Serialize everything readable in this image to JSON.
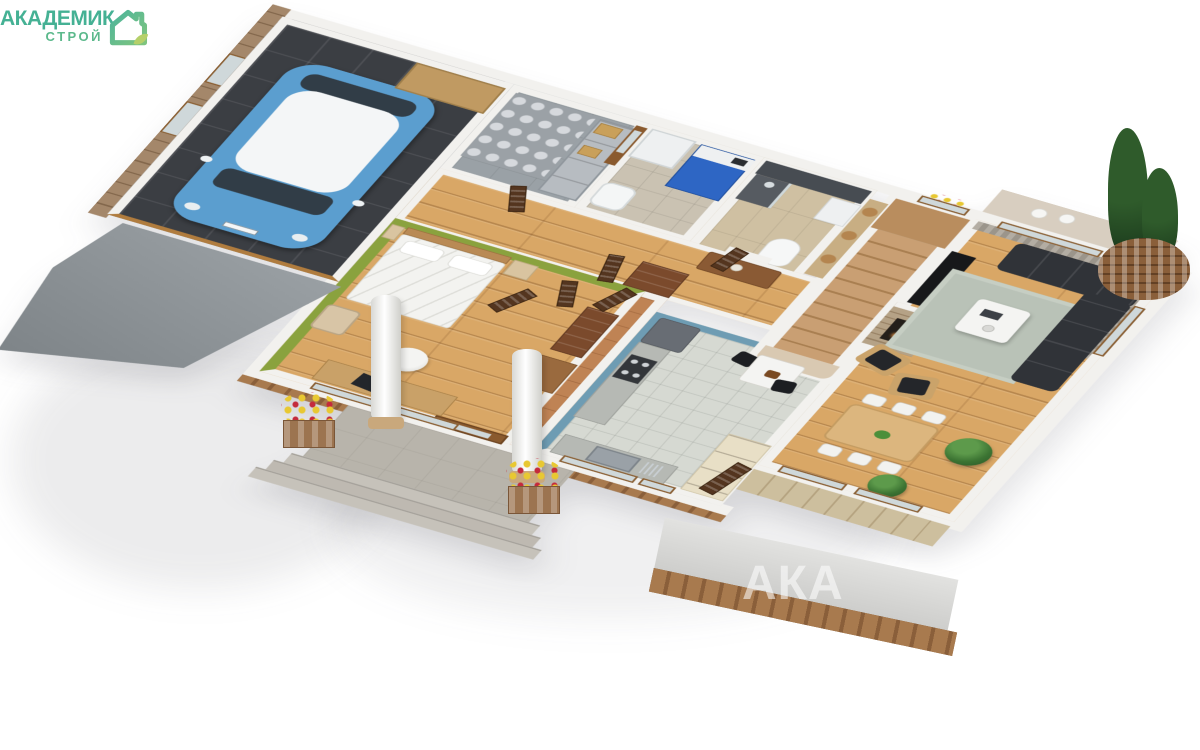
{
  "meta": {
    "image_type": "3D isometric cutaway floor plan render of a single-storey house",
    "background": "#ffffff"
  },
  "logo": {
    "title": "АКАДЕМИК",
    "subtitle": "СТРОЙ",
    "icon": "house-leaf-icon",
    "color_primary": "#45b194",
    "color_secondary": "#5cb98c",
    "color_leaf": "#b5d06a"
  },
  "watermark": {
    "text": "АКА",
    "color": "rgba(255,255,255,0.55)"
  },
  "palette": {
    "walls": "#f2f1ee",
    "wood_floor": "#d9a766",
    "garage_tile": "#3b3e43",
    "kitchen_tile": "#d6d9d2",
    "terracotta_tile": "#bf8354",
    "green_accent_wall": "#8aa23e",
    "blue_accent_wall": "#6e9cb3",
    "slate_bath_wall": "#474c52",
    "boiler_blue": "#2e66c4",
    "car_blue": "#5b9ecf",
    "sofa_charcoal": "#303338",
    "brick": "#946a42"
  },
  "rooms": [
    {
      "name": "garage",
      "floor": "dark grey tiles",
      "contents": [
        "blue mini car with white roof",
        "wooden workbench",
        "wood-panelled wall with two windows"
      ]
    },
    {
      "name": "storage-room",
      "floor": "grey concrete",
      "contents": [
        "stacked sacks",
        "metal shelving",
        "cardboard boxes",
        "glazed wooden door"
      ]
    },
    {
      "name": "boiler-room",
      "floor": "beige tile",
      "contents": [
        "white washing machine",
        "blue boiler",
        "white laundry tub"
      ]
    },
    {
      "name": "bathroom",
      "floor": "light wood-look tile",
      "contents": [
        "slate tiled wall",
        "shower",
        "toilet",
        "vanity unit"
      ]
    },
    {
      "name": "staircase",
      "floor": "wood treads",
      "contents": [
        "upper landing",
        "small window with flowers"
      ]
    },
    {
      "name": "living-room",
      "floor": "oak planks",
      "contents": [
        "charcoal corner sofa",
        "white coffee table on grey-green rug",
        "two wooden armchairs with black cushions",
        "stone fireplace",
        "black media bench",
        "grey curtains",
        "glazed terrace doors",
        "terrace with white chairs"
      ]
    },
    {
      "name": "dining-area",
      "floor": "oak planks",
      "contents": [
        "wooden dining table",
        "six white chairs",
        "bowl of fruit",
        "potted plants"
      ]
    },
    {
      "name": "kitchen",
      "floor": "light grey tile",
      "contents": [
        "blue accent walls",
        "grey worktop with gas hob",
        "tall grey fridge",
        "white bistro table with two black chairs",
        "stainless sink under window",
        "cream shelving unit"
      ]
    },
    {
      "name": "entry-foyer",
      "floor": "terracotta tile",
      "contents": [
        "front door with mirror glass",
        "open slatted doors"
      ]
    },
    {
      "name": "hallway",
      "floor": "oak planks",
      "contents": [
        "sideboard with lamp",
        "wooden dresser",
        "basket shelf"
      ]
    },
    {
      "name": "bedroom",
      "floor": "oak planks",
      "contents": [
        "olive-green accent walls",
        "double bed with white bedding",
        "nightstands",
        "desk with laptop",
        "white office chair",
        "suitcase",
        "two wooden dressers"
      ]
    }
  ],
  "exterior": {
    "driveway": "concrete ramp sloping from garage",
    "porch": [
      "concrete platform",
      "three steps",
      "two white columns",
      "flower planters with yellow and red flowers"
    ],
    "landscaping": [
      "round brick planter with two cypress trees"
    ],
    "foundation": "brick plinth visible under front walls"
  }
}
